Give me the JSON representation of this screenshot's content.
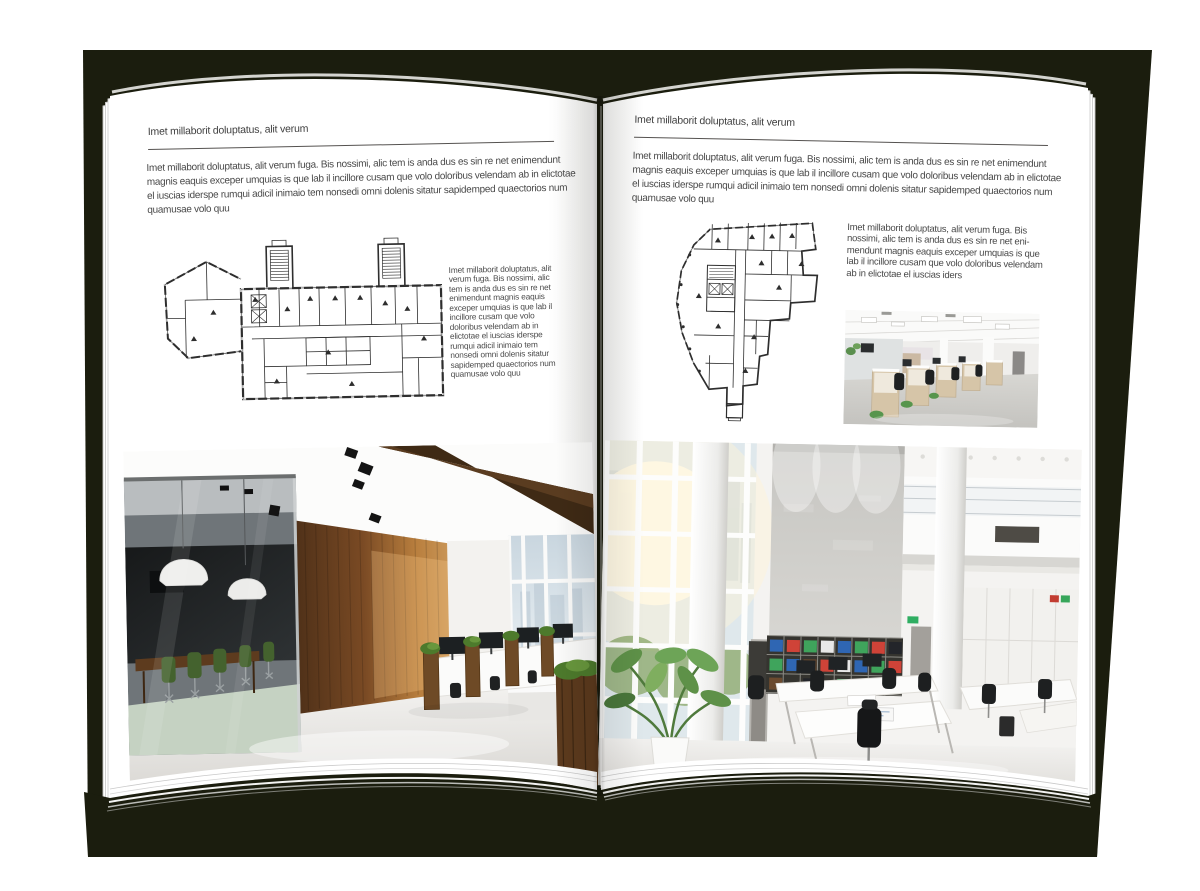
{
  "book": {
    "cover_color": "#1b1d0e",
    "page_color": "#ffffff",
    "text_color": "#4a4a4a"
  },
  "left_page": {
    "header": "Imet millaborit doluptatus, alit verum",
    "intro": "Imet millaborit doluptatus, alit verum fuga. Bis nossimi, alic tem is anda dus es sin re net enimendunt magnis eaquis exceper umquias is que lab il incillore cusam que volo doloribus velendam ab in elictotae el iuscias iderspe rumqui adicil inimaio tem nonsedi omni dolenis sitatur sapidemped quaectorios num quamusae volo quu",
    "side_text": "Imet millaborit doluptatus, alit verum fuga. Bis nossimi, alic tem is anda dus es sin re net enimendunt magnis eaquis exceper umquias is que lab il incillore cusam que volo doloribus velendam ab in elictotae el iuscias iderspe rumqui adicil inimaio tem nonsedi omni dolenis sitatur sapidemped quaectorios num quamusae volo quu",
    "figures": {
      "floorplan": "wide-building-floorplan-with-stair-towers",
      "photo": "loft-office-glass-meeting-room-wood-wall"
    }
  },
  "right_page": {
    "header": "Imet millaborit doluptatus, alit verum",
    "intro": "Imet millaborit doluptatus, alit verum fuga. Bis nossimi, alic tem is anda dus es sin re net enimendunt magnis eaquis exceper umquias is que lab il incillore cusam que volo doloribus velendam ab in elictotae el iuscias iderspe rumqui adicil inimaio tem nonsedi omni dolenis sitatur sapidemped quaectorios num quamusae volo quu",
    "side_text": "Imet millaborit doluptatus, alit verum fuga. Bis nossimi, alic tem is anda dus es sin re net eni-mendunt magnis eaquis exceper umquias is que lab il incillore cusam que volo doloribus velendam ab in elictotae el iuscias iders",
    "figures": {
      "floorplan": "irregular-tower-floorplan",
      "photo_small": "open-office-cubicle-workstations",
      "photo_large": "double-height-white-office-bookshelf-wall"
    }
  }
}
